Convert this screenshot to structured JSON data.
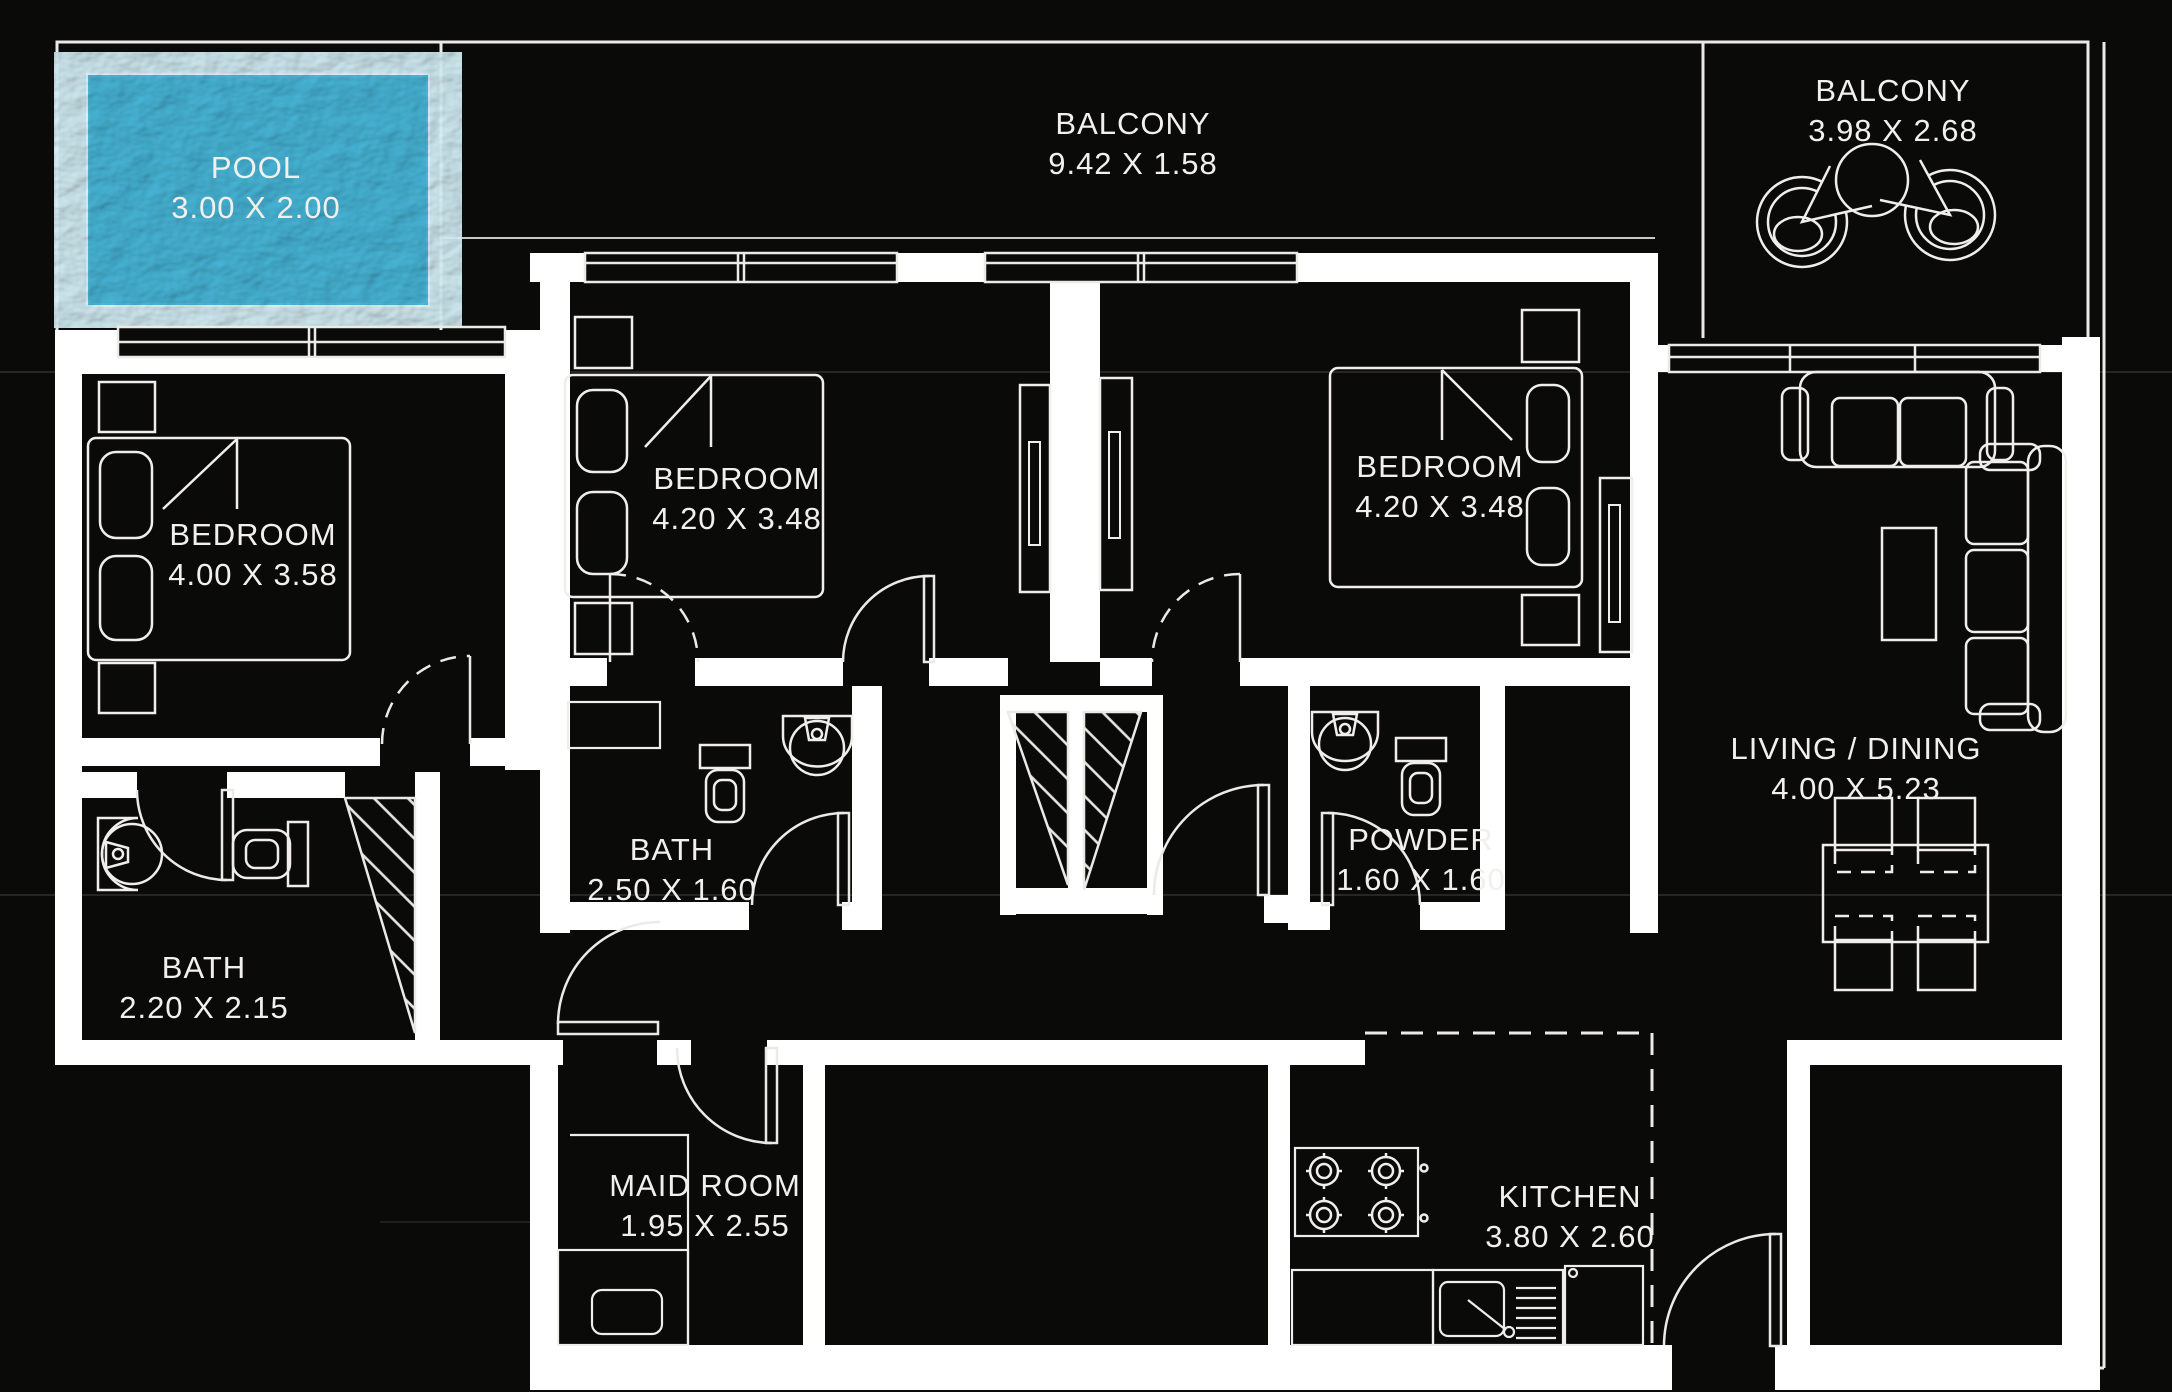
{
  "plan_title": "apartment floor plan",
  "colors": {
    "background": "#0a0a09",
    "walls": "#ffffff",
    "linework": "#eceae6",
    "text": "#f2f0ec",
    "pool_water": "#3aa0c2"
  },
  "rooms": {
    "pool": {
      "name": "POOL",
      "dims": "3.00 X 2.00"
    },
    "balcony_top": {
      "name": "BALCONY",
      "dims": "9.42 X 1.58"
    },
    "balcony_right": {
      "name": "BALCONY",
      "dims": "3.98 X 2.68"
    },
    "bedroom_left": {
      "name": "BEDROOM",
      "dims": "4.00 X 3.58"
    },
    "bedroom_middle": {
      "name": "BEDROOM",
      "dims": "4.20 X 3.48"
    },
    "bedroom_right": {
      "name": "BEDROOM",
      "dims": "4.20 X 3.48"
    },
    "bath_left": {
      "name": "BATH",
      "dims": "2.20 X 2.15"
    },
    "bath_middle": {
      "name": "BATH",
      "dims": "2.50 X 1.60"
    },
    "powder": {
      "name": "POWDER",
      "dims": "1.60 X 1.60"
    },
    "living_dining": {
      "name": "LIVING / DINING",
      "dims": "4.00 X 5.23"
    },
    "maid_room": {
      "name": "MAID ROOM",
      "dims": "1.95 X 2.55"
    },
    "kitchen": {
      "name": "KITCHEN",
      "dims": "3.80 X 2.60"
    }
  }
}
